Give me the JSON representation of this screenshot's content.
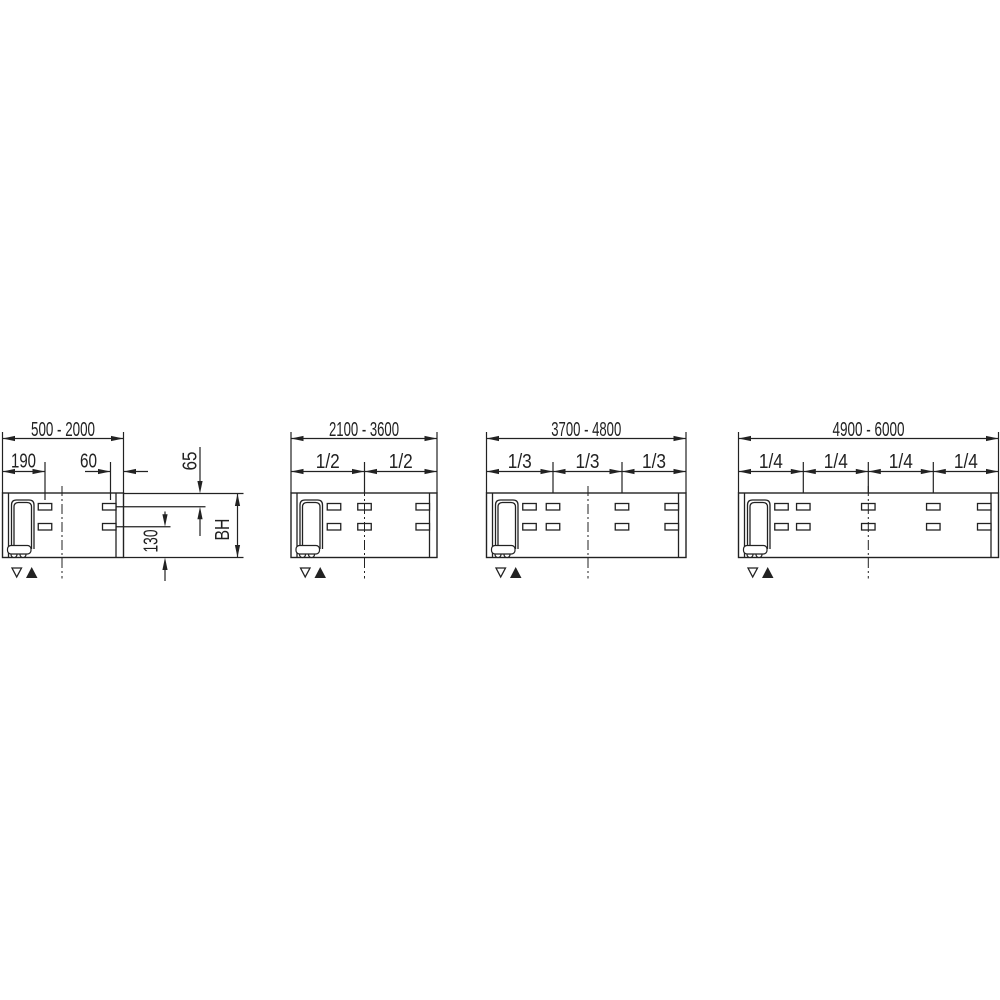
{
  "drawing": {
    "background_color": "#ffffff",
    "line_color": "#222222",
    "description_labels": {
      "box_height": "BH"
    },
    "panels": [
      {
        "range": "500 - 2000",
        "fractions": [],
        "dims": {
          "left_slot_offset": "190",
          "right_slot_offset": "60",
          "top_row_offset": "65",
          "bottom_row_offset": "130",
          "box_height": "BH"
        },
        "symbols": {
          "down_triangle": "▽",
          "up_triangle": "▲"
        }
      },
      {
        "range": "2100 - 3600",
        "fractions": [
          "1/2",
          "1/2"
        ],
        "symbols": {
          "down_triangle": "▽",
          "up_triangle": "▲"
        }
      },
      {
        "range": "3700 - 4800",
        "fractions": [
          "1/3",
          "1/3",
          "1/3"
        ],
        "symbols": {
          "down_triangle": "▽",
          "up_triangle": "▲"
        }
      },
      {
        "range": "4900 - 6000",
        "fractions": [
          "1/4",
          "1/4",
          "1/4",
          "1/4"
        ],
        "symbols": {
          "down_triangle": "▽",
          "up_triangle": "▲"
        }
      }
    ]
  }
}
